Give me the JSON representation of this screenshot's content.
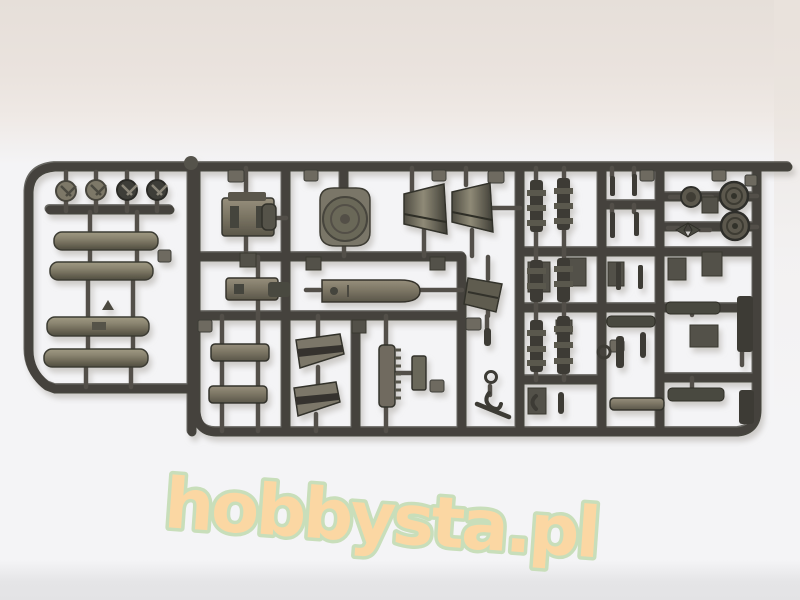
{
  "photo": {
    "subject": "Photograph of an injection-moulded plastic model-kit sprue (olive-grey styrene) lying on a light backdrop",
    "plastic_colors": {
      "dark": "#45443d",
      "mid": "#5c5a50",
      "light": "#8b8679"
    },
    "backdrop": {
      "wall": "#e8e1dc",
      "surface": "#f4f4f6",
      "surface_edge": "#e5e5e7"
    },
    "parts": [
      "hub caps (4)",
      "stowage cylinders / fuel tanks (4)",
      "gun breech block",
      "round hatch dome",
      "conical exhaust covers (2)",
      "track-link runs (6)",
      "road wheels (3)",
      "axle pins",
      "suspension bogie bars (2)",
      "armor wedge plates (2)",
      "toothed ladder rack",
      "paddle-shaped cover",
      "angled plates",
      "tow hooks and small fittings",
      "stowage bars"
    ]
  },
  "watermark": {
    "text": "hobbysta.pl",
    "fill": "#fbd7a3",
    "outline": "#c8deba"
  }
}
